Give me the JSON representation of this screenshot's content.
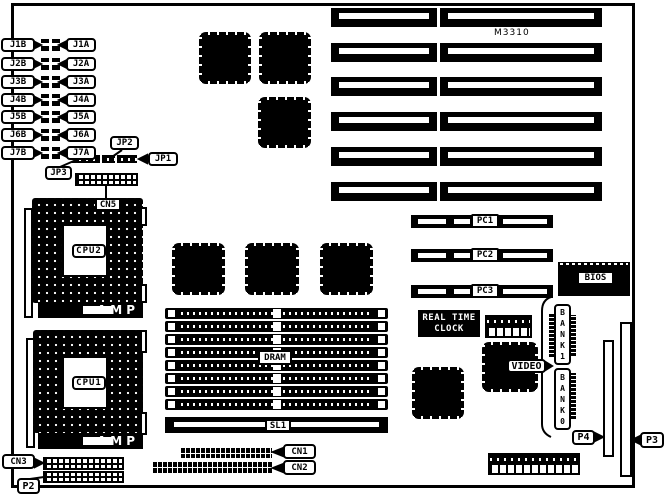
{
  "chips": {
    "m3310": "M3310",
    "cpu1": "CPU1",
    "cpu2": "CPU2",
    "amp": "AMP",
    "bios": "BIOS",
    "video": "VIDEO",
    "rtc": [
      "REAL TIME",
      "CLOCK"
    ],
    "dram": "DRAM"
  },
  "slots": {
    "sl1": "SL1",
    "pci": [
      "PC1",
      "PC2",
      "PC3"
    ],
    "bank1": [
      "B",
      "A",
      "N",
      "K",
      "1"
    ],
    "bank0": [
      "B",
      "A",
      "N",
      "K",
      "0"
    ],
    "p3": "P3",
    "p4": "P4"
  },
  "connectors": {
    "cn1": "CN1",
    "cn2": "CN2",
    "cn3": "CN3",
    "cn5": "CN5",
    "p2": "P2"
  },
  "jumpers": {
    "jp1": "JP1",
    "jp2": "JP2",
    "jp3": "JP3",
    "rows": [
      {
        "left": "J1B",
        "right": "J1A"
      },
      {
        "left": "J2B",
        "right": "J2A"
      },
      {
        "left": "J3B",
        "right": "J3A"
      },
      {
        "left": "J4B",
        "right": "J4A"
      },
      {
        "left": "J5B",
        "right": "J5A"
      },
      {
        "left": "J6B",
        "right": "J6A"
      },
      {
        "left": "J7B",
        "right": "J7A"
      }
    ]
  }
}
